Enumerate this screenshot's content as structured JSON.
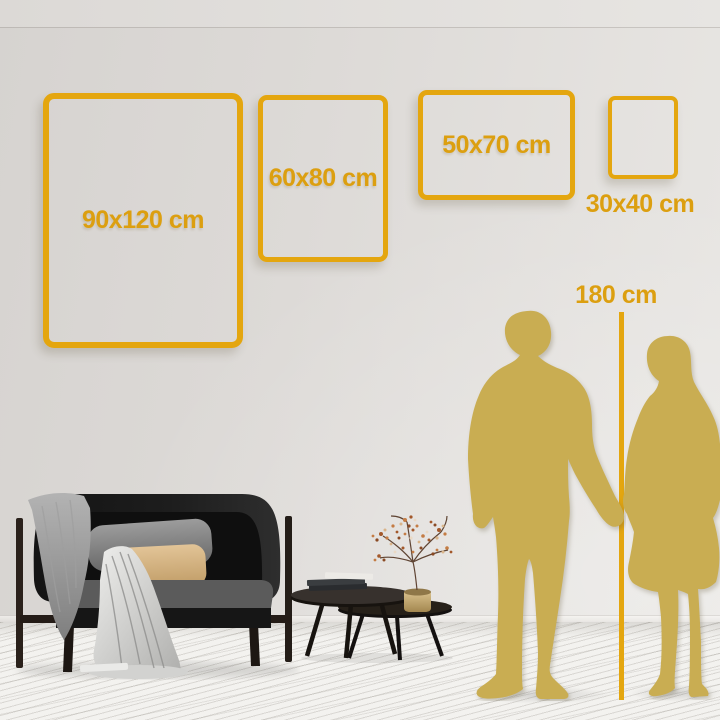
{
  "frames": [
    {
      "label": "90x120 cm"
    },
    {
      "label": "60x80 cm"
    },
    {
      "label": "50x70 cm"
    },
    {
      "label": "30x40 cm"
    }
  ],
  "height_reference": {
    "label": "180 cm"
  },
  "colors": {
    "accent_gold": "#E4A60F",
    "label_gold": "#DC9F10",
    "silhouette_gold": "#C9AD52",
    "wall_gray": "#DDDAD7",
    "floor_white": "#F3F2EF",
    "sofa_dark": "#1B1B1B",
    "pillow_tan": "#D9BD92",
    "vase_brass": "#C9B286"
  },
  "scene_items": {
    "sofa": "sofa",
    "tables": "nesting-coffee-tables",
    "plant": "dried-plant-in-vase",
    "man": "man-silhouette",
    "woman": "woman-silhouette",
    "ruler": "height-ruler"
  }
}
